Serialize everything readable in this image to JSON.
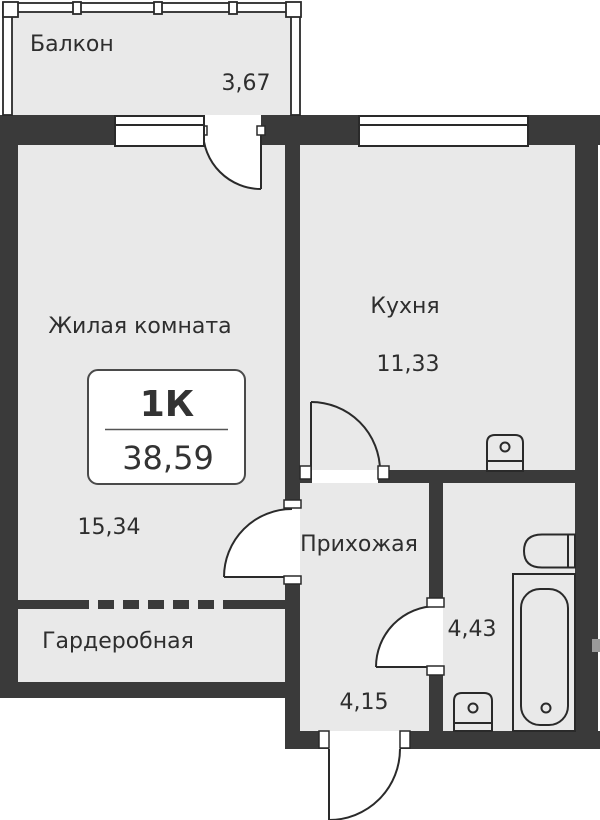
{
  "badge": {
    "type": "1К",
    "total_area": "38,59"
  },
  "rooms": {
    "balcony": {
      "label": "Балкон",
      "area": "3,67"
    },
    "living": {
      "label": "Жилая комната",
      "area": "15,34"
    },
    "kitchen": {
      "label": "Кухня",
      "area": "11,33"
    },
    "hallway": {
      "label": "Прихожая",
      "area": "4,15"
    },
    "bathroom": {
      "area": "4,43"
    },
    "wardrobe": {
      "label": "Гардеробная"
    }
  },
  "colors": {
    "bg": "#ffffff",
    "floor": "#e9e9e9",
    "wall": "#3a3a3a",
    "line": "#2a2a2a",
    "text": "#2e2e2e"
  }
}
